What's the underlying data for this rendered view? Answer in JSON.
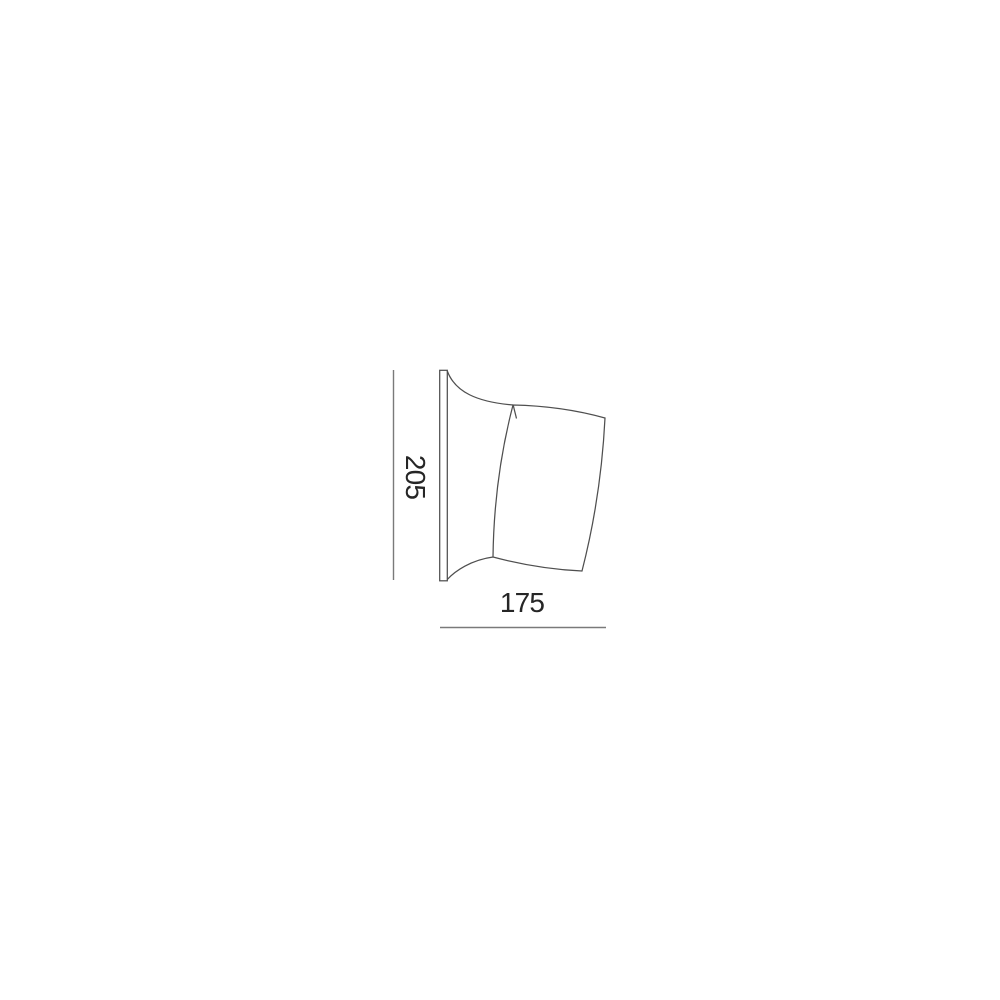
{
  "page": {
    "background_color": "#ffffff"
  },
  "diagram": {
    "type": "technical-line-drawing",
    "subject": "wall-lamp-side-elevation",
    "labels": {
      "height_dimension": "205",
      "width_dimension": "175"
    },
    "colors": {
      "outline": "#4f4f4f",
      "dimension_line": "#7a7a7a",
      "label_text": "#262626"
    }
  }
}
